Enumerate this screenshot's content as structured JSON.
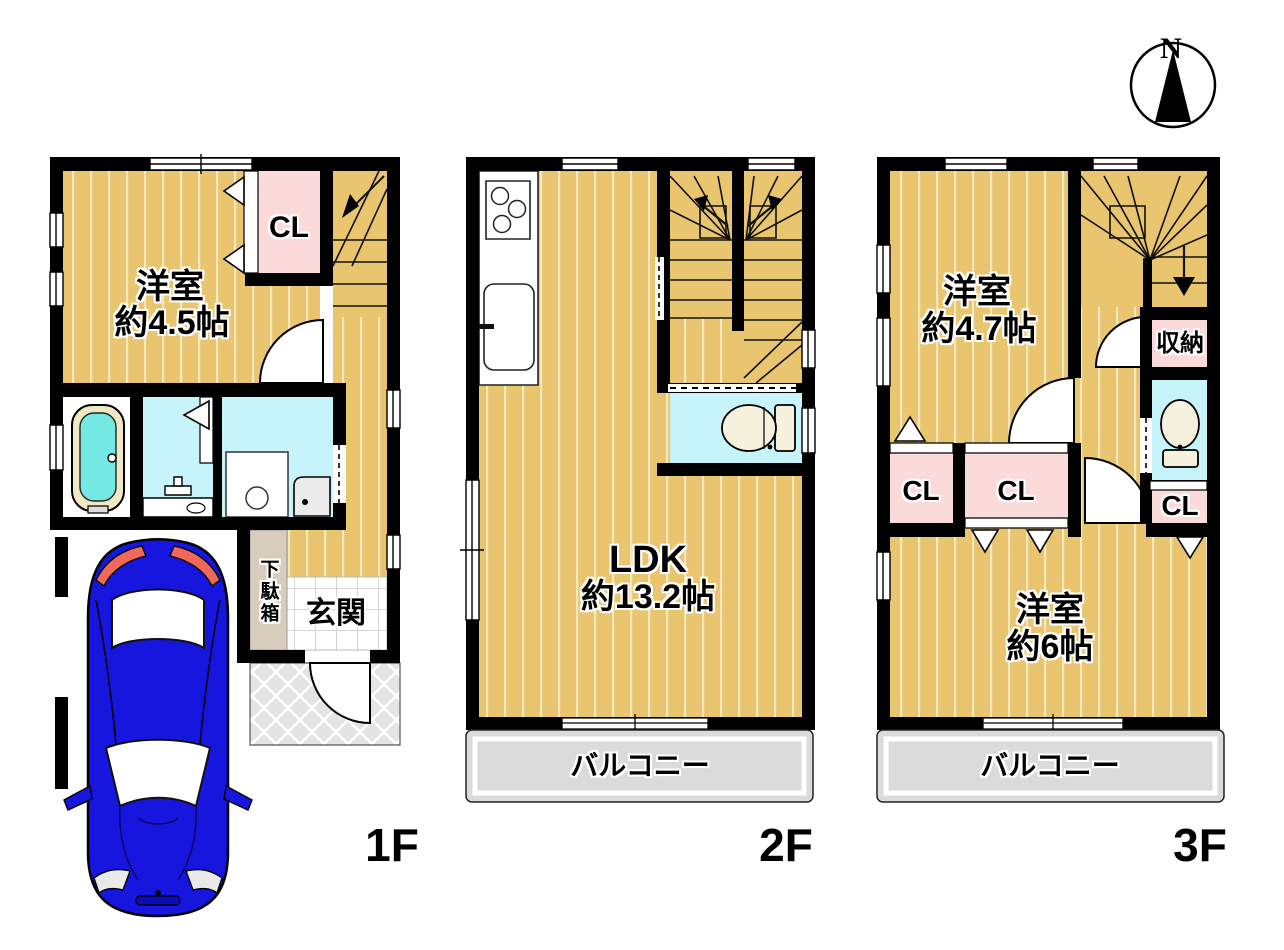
{
  "compass": {
    "north": "N"
  },
  "floors": {
    "f1": {
      "label": "1F",
      "bedroom": {
        "name": "洋室",
        "size": "約4.5帖"
      },
      "closet": "CL",
      "shoe_box": "下駄箱",
      "entrance": "玄関"
    },
    "f2": {
      "label": "2F",
      "ldk": {
        "name": "LDK",
        "size": "約13.2帖"
      },
      "balcony": "バルコニー"
    },
    "f3": {
      "label": "3F",
      "bedroom_a": {
        "name": "洋室",
        "size": "約4.7帖"
      },
      "storage": "収納",
      "closet_a": "CL",
      "closet_b": "CL",
      "closet_c": "CL",
      "bedroom_b": {
        "name": "洋室",
        "size": "約6帖"
      },
      "balcony": "バルコニー"
    }
  },
  "colors": {
    "floor": "#E8C56E",
    "floor_stripe": "#F6E8BC",
    "closet_pink": "#FBDADA",
    "wet_cyan": "#C7F3FA",
    "water_cyan": "#74E8E2",
    "tub_cream": "#F0E9C2",
    "fixture_ivory": "#F5F1DC",
    "balcony_gray": "#DBDBDB",
    "porch_gray": "#E4E4E4",
    "tile_line": "#C9C9C9",
    "shoe_beige": "#D8CCBC",
    "wall_black": "#000000",
    "car_blue": "#1616DF",
    "car_red": "#F0685A"
  }
}
